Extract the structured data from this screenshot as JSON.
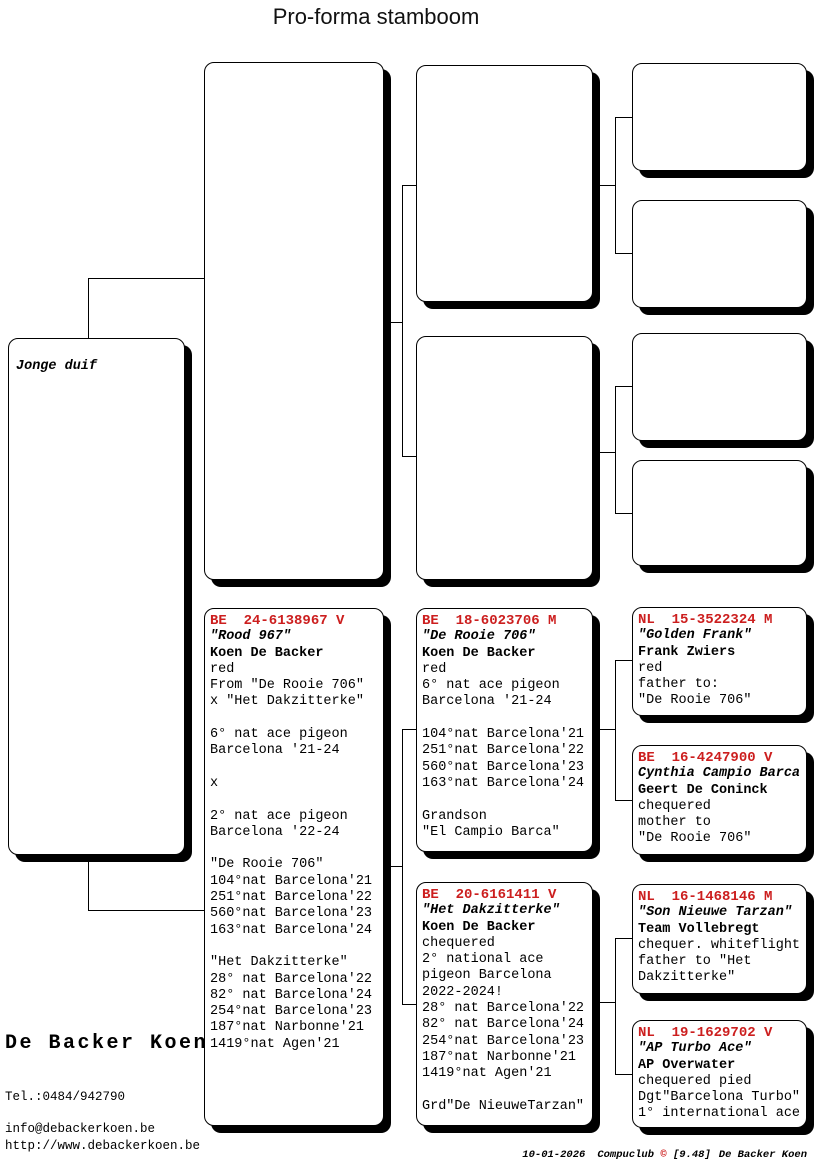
{
  "title": "Pro-forma stamboom",
  "subject_label": "Jonge duif",
  "accent_red": "#cc1e1e",
  "pedigree": {
    "dam": {
      "ring": "BE  24-6138967 V",
      "name": "\"Rood 967\"",
      "owner": "Koen De Backer",
      "details": [
        "red",
        "From \"De Rooie 706\"",
        "x \"Het Dakzitterke\"",
        "",
        "6° nat ace pigeon",
        "Barcelona '21-24",
        "",
        "x",
        "",
        "2° nat ace pigeon",
        "Barcelona '22-24",
        "",
        "\"De Rooie 706\"",
        "104°nat Barcelona'21",
        "251°nat Barcelona'22",
        "560°nat Barcelona'23",
        "163°nat Barcelona'24",
        "",
        "\"Het Dakzitterke\"",
        "28° nat Barcelona'22",
        "82° nat Barcelona'24",
        "254°nat Barcelona'23",
        "187°nat Narbonne'21",
        "1419°nat Agen'21"
      ]
    },
    "dam_sire": {
      "ring": "BE  18-6023706 M",
      "name": "\"De Rooie 706\"",
      "owner": "Koen De Backer",
      "details": [
        "red",
        "6° nat ace pigeon",
        "Barcelona '21-24",
        "",
        "104°nat Barcelona'21",
        "251°nat Barcelona'22",
        "560°nat Barcelona'23",
        "163°nat Barcelona'24",
        "",
        "Grandson",
        "\"El Campio Barca\""
      ]
    },
    "dam_dam": {
      "ring": "BE  20-6161411 V",
      "name": "\"Het Dakzitterke\"",
      "owner": "Koen De Backer",
      "details": [
        "chequered",
        "2° national ace",
        "pigeon Barcelona",
        "2022-2024!",
        "28° nat Barcelona'22",
        "82° nat Barcelona'24",
        "254°nat Barcelona'23",
        "187°nat Narbonne'21",
        "1419°nat Agen'21",
        "",
        "Grd\"De NieuweTarzan\""
      ]
    },
    "dam_sire_sire": {
      "ring": "NL  15-3522324 M",
      "name": "\"Golden Frank\"",
      "owner": "Frank Zwiers",
      "details": [
        "red",
        "father to:",
        "\"De Rooie 706\""
      ]
    },
    "dam_sire_dam": {
      "ring": "BE  16-4247900 V",
      "name": "Cynthia Campio Barca",
      "owner": "Geert De Coninck",
      "details": [
        "chequered",
        "mother to",
        "\"De Rooie 706\""
      ]
    },
    "dam_dam_sire": {
      "ring": "NL  16-1468146 M",
      "name": "\"Son Nieuwe Tarzan\"",
      "owner": "Team Vollebregt",
      "details": [
        "chequer. whiteflight",
        "father to \"Het",
        "Dakzitterke\""
      ]
    },
    "dam_dam_dam": {
      "ring": "NL  19-1629702 V",
      "name": "\"AP Turbo Ace\"",
      "owner": "AP Overwater",
      "details": [
        "chequered pied",
        "Dgt\"Barcelona Turbo\"",
        "1° international ace"
      ]
    }
  },
  "owner_block": {
    "name": "De Backer Koen",
    "phone": "Tel.:0484/942790",
    "email": "info@debackerkoen.be",
    "website": "http://www.debackerkoen.be"
  },
  "footer": {
    "date": "10-01-2026",
    "program": "Compuclub",
    "copyright": "©",
    "version": "[9.48]",
    "owner": "De Backer Koen"
  }
}
